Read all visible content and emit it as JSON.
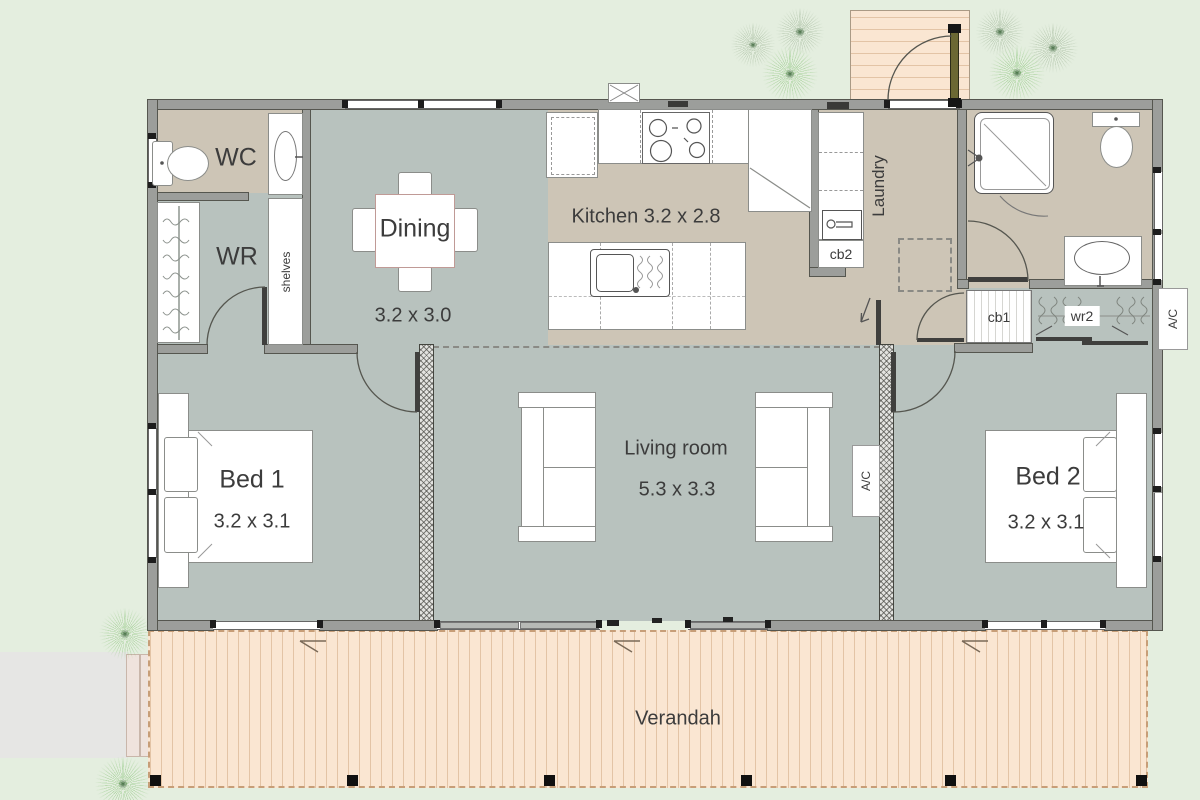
{
  "plan": {
    "title": "3-bedroom cottage floor plan",
    "rooms": {
      "wc": {
        "label": "WC"
      },
      "wr": {
        "label": "WR"
      },
      "dining": {
        "label": "Dining",
        "dims": "3.2 x 3.0"
      },
      "kitchen": {
        "label": "Kitchen 3.2 x 2.8"
      },
      "laundry": {
        "label": "Laundry"
      },
      "bed1": {
        "label": "Bed 1",
        "dims": "3.2 x 3.1"
      },
      "living": {
        "label": "Living room",
        "dims": "5.3 x 3.3"
      },
      "bed2": {
        "label": "Bed 2",
        "dims": "3.2 x 3.1"
      },
      "verandah": {
        "label": "Verandah"
      }
    },
    "cabinets": {
      "shelves": "shelves",
      "cb1": "cb1",
      "cb2": "cb2",
      "wr2": "wr2"
    },
    "units": {
      "ac": "A/C"
    },
    "colors": {
      "lawn": "#e4eedf",
      "floor_living": "#b8c2be",
      "floor_wet": "#cdc5b6",
      "deck": "#fae6d2",
      "wall": "#9c9e9b",
      "fixture_white": "#ffffff",
      "text": "#3c3c3c"
    }
  }
}
